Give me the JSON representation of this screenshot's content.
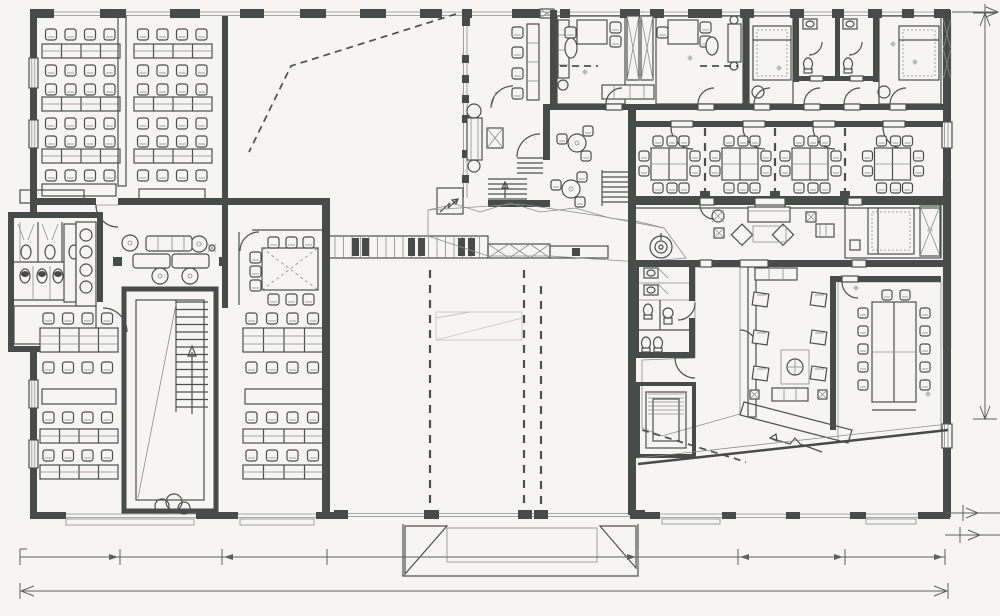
{
  "meta": {
    "title": "Hand-sketched architectural floor plan of an office / school building",
    "drawing_type": "ink floor plan sketch on scanned paper, fully furnished, with dimension lines"
  },
  "colors": {
    "paper": "#f6f5f1",
    "ink": "#4b504d",
    "inklight": "#8a8f8b",
    "wall": "#474b49",
    "hatch": "#a0a5a1",
    "hatchdark": "#70756f",
    "tile": "#c9cdc9",
    "dots": "#8f948f",
    "dim": "#5c615c",
    "faint": "#c5c8c3",
    "diamond": "#b9bdb8"
  },
  "plan": {
    "north_west": {
      "classrooms": [
        {
          "desk_columns": 4,
          "desk_bands": 3,
          "chair_rows": 6
        },
        {
          "desk_columns": 4,
          "desk_bands": 3,
          "chair_rows": 6
        }
      ],
      "open_hall": {
        "dashed_route_line": true
      }
    },
    "entry_core": {
      "waiting_chairs": 4,
      "console_shelf": true,
      "couch": true,
      "stairs": 2
    },
    "north_east_wing": {
      "offices": [
        {
          "desk_chairs": 3,
          "wardrobe": true,
          "rug": true,
          "sofa": true
        },
        {
          "desk_chairs": 3,
          "rug": true,
          "sofa": true
        }
      ],
      "bedrooms": 2,
      "bathrooms": {
        "count": 2,
        "sinks": 2,
        "toilets": 2
      },
      "floor_texture": "diagonal hatch"
    },
    "east_meeting_rooms": {
      "count": 4,
      "chairs_per_room": 10,
      "partitions": "dashed"
    },
    "cafe_corner": {
      "round_tables": 2,
      "chairs_per_table": 3
    },
    "center_band": {
      "lounge": {
        "sofas": 3,
        "round_tables": 4,
        "side_tables": 2
      },
      "meeting_room": {
        "table": 1,
        "chairs": 9
      },
      "locker_wall_bays": 18,
      "walkway_texture": "speckled dots",
      "spiral_feature": true
    },
    "west_washrooms": {
      "stalls": 3,
      "wall_toilets": 3,
      "sinks": 4,
      "floor": "tile"
    },
    "south_west": {
      "classrooms": [
        {
          "desk_columns": 4,
          "desk_bands": 3,
          "chair_rows": 4,
          "crosshatch_band": true
        },
        {
          "desk_columns": 4,
          "desk_bands": 3,
          "chair_rows": 4,
          "crosshatch_band": true
        }
      ],
      "stairwell": {
        "flight_arrow": "up",
        "plant_at_entry": true
      }
    },
    "south_hall": {
      "empty": true,
      "dashed_setout_lines": 3,
      "faint_stage_outline": true
    },
    "south_east_wing": {
      "lounge_1": {
        "sofa": 1,
        "armchairs": 2,
        "rug": 1,
        "plant": 1,
        "lamp_tables": 2
      },
      "bedroom": {
        "bed": 1
      },
      "lounge_2": {
        "armchairs": 6,
        "circular_rug": 1,
        "sofa": 1,
        "shelf": 1
      },
      "conference_room": {
        "long_table": 1,
        "chairs": 12
      },
      "wc": {
        "sinks": 2,
        "toilets": 3,
        "basin": 1
      },
      "elevator_core": true,
      "ramp": "hatched diagonal",
      "lobby_floor": "tile grid"
    },
    "entrances": {
      "south_center_thresholds": 2,
      "south_east_thresholds": 2
    }
  },
  "dimensions": {
    "bottom_primary_line": {
      "ticks_x": [
        20,
        120,
        222,
        327,
        638,
        738,
        845,
        945
      ],
      "y": 557
    },
    "bottom_overall_line": {
      "span_x": [
        20,
        948
      ],
      "y": 591,
      "arrowheads": "both ends"
    },
    "right_vertical_line": {
      "x": 985,
      "span_y": [
        13,
        419
      ],
      "arrowheads": "both ends"
    },
    "corner_marks": [
      "top-right arrow",
      "bottom-right double marks"
    ]
  }
}
